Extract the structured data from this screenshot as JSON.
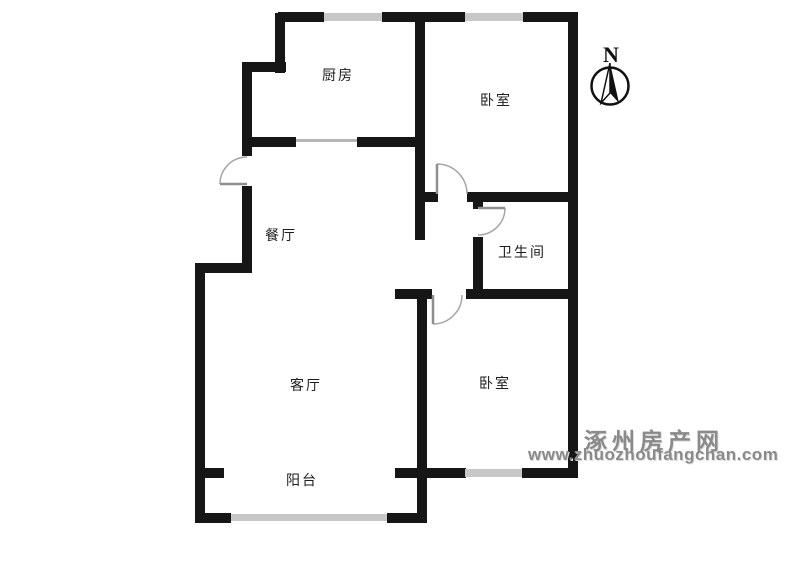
{
  "page": {
    "type": "residential-floor-plan"
  },
  "rooms": {
    "kitchen": "厨房",
    "bedroom_north": "卧室",
    "dining": "餐厅",
    "bathroom": "卫生间",
    "living": "客厅",
    "bedroom_south": "卧室",
    "balcony": "阳台"
  },
  "compass": {
    "north_label": "N"
  },
  "watermark": {
    "site_name": "涿州房产网",
    "site_url": "www.zhuozhoufangchan.com"
  },
  "colors": {
    "wall": "#161616",
    "window": "#c7c7c7",
    "door_arc": "#a5a5a5",
    "watermark": "#8a8a8a",
    "label": "#1c1c1c",
    "background": "#ffffff"
  }
}
